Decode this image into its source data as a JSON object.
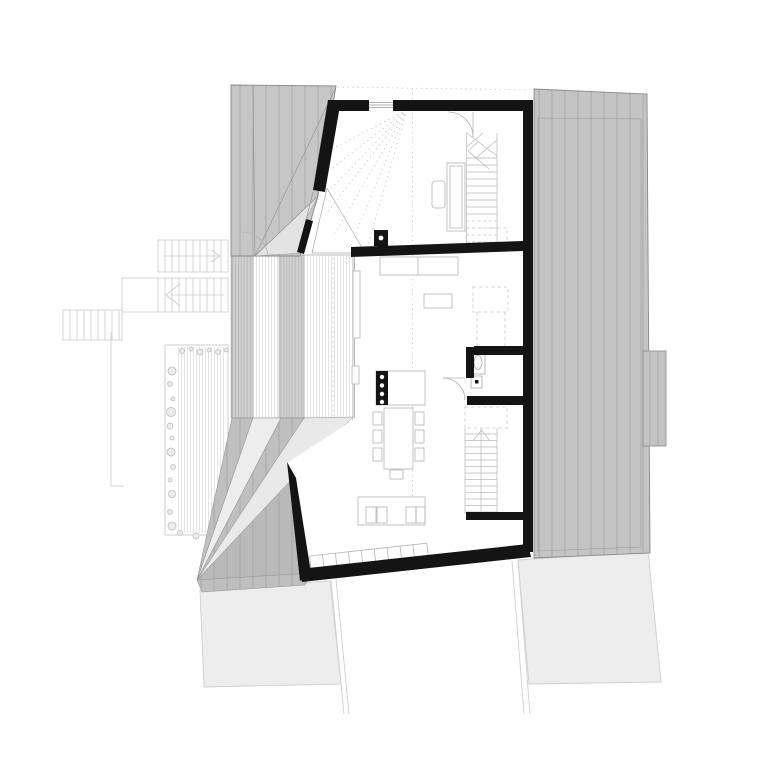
{
  "canvas": {
    "width": 780,
    "height": 780,
    "background": "#ffffff"
  },
  "drawing": {
    "kind": "architectural floor plan (roof / upper level site plan)",
    "text_labels": [],
    "burner_dots": 4,
    "dining_chairs": 7,
    "staircases": 2
  },
  "colors": {
    "background": "#ffffff",
    "wall": "#141414",
    "roof_fill": "#c6c6c6",
    "roof_fill_right": "#c4c4c4",
    "fan_gray": "#bfbfbf",
    "fan_light": "#ededed",
    "fan_light2": "#e9e9e9",
    "fan_dark": "#b9b9b9",
    "roof_wedge_light": "#e3e3e3",
    "interior": "#ffffff",
    "triangle_white": "#ffffff",
    "neighbor_fill": "#ededed",
    "chimney_fill": "#c3c3c3",
    "cooktop": "#141414",
    "burner": "#ffffff"
  }
}
